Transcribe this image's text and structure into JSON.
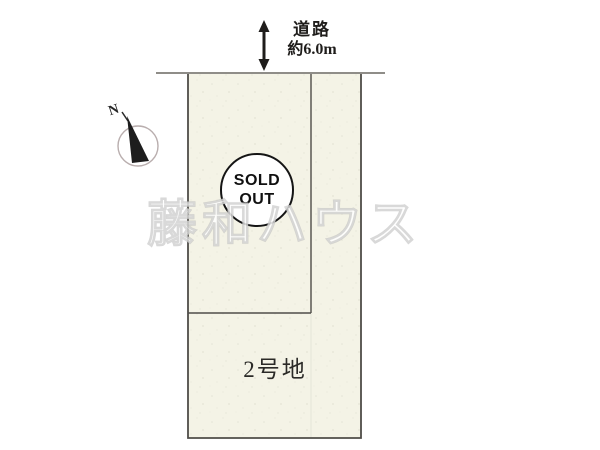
{
  "title": "土地区画図",
  "road": {
    "label": "道路",
    "dimension": "約6.0m"
  },
  "compass": {
    "label": "N"
  },
  "badge": {
    "line1": "SOLD",
    "line2": "OUT"
  },
  "watermark": {
    "text": "藤和ハウス"
  },
  "plots": [
    {
      "id": "plot-1",
      "label": "",
      "status": "SOLD OUT"
    },
    {
      "id": "plot-2",
      "label": "2号地",
      "status": ""
    }
  ],
  "colors": {
    "page_bg": "#ffffff",
    "parcel_fill": "#f4f3e6",
    "parcel_line": "#4f4d48",
    "road_line": "#8f8d88",
    "ink": "#1f1d1b",
    "badge_border": "#151515",
    "watermark_fill": "#ffffff"
  }
}
